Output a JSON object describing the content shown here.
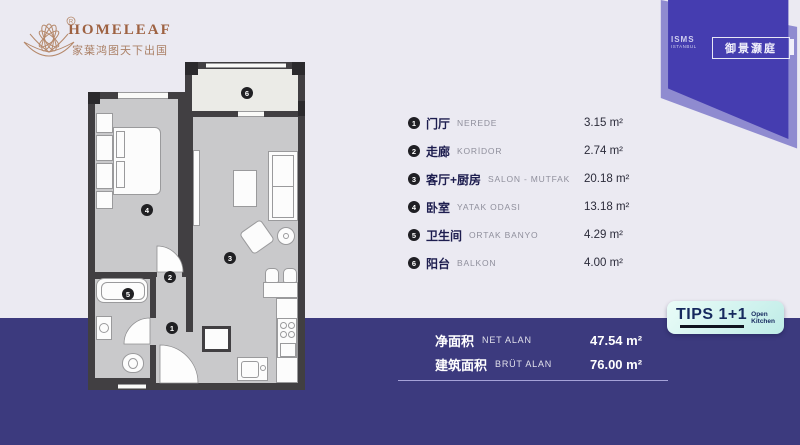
{
  "brand": {
    "name": "HOMELEAF",
    "tagline": "家葉鸿图天下出国",
    "registered_mark": "®"
  },
  "project_badge": {
    "name_line1": "ISMS",
    "name_line2": "ISTANBUL",
    "title_cn": "御景灏庭"
  },
  "tips_badge": {
    "title": "TIPS 1+1",
    "subtitle_line1": "Open",
    "subtitle_line2": "Kitchen"
  },
  "legend": {
    "rows": [
      {
        "num": "1",
        "cn": "门厅",
        "tr": "NEREDE",
        "area": "3.15 m²"
      },
      {
        "num": "2",
        "cn": "走廊",
        "tr": "KORİDOR",
        "area": "2.74 m²"
      },
      {
        "num": "3",
        "cn": "客厅+厨房",
        "tr": "SALON - MUTFAK",
        "area": "20.18 m²"
      },
      {
        "num": "4",
        "cn": "卧室",
        "tr": "YATAK ODASI",
        "area": "13.18 m²"
      },
      {
        "num": "5",
        "cn": "卫生间",
        "tr": "ORTAK BANYO",
        "area": "4.29 m²"
      },
      {
        "num": "6",
        "cn": "阳台",
        "tr": "BALKON",
        "area": "4.00 m²"
      }
    ]
  },
  "totals": {
    "rows": [
      {
        "cn": "净面积",
        "tr": "NET ALAN",
        "area": "47.54 m²"
      },
      {
        "cn": "建筑面积",
        "tr": "BRÜT ALAN",
        "area": "76.00 m²"
      }
    ]
  },
  "colors": {
    "background": "#ebeaf2",
    "band": "#3c3a7e",
    "flag": "#453db0",
    "flag_shadow": "#8f8bd0",
    "wall": "#413f42",
    "floor": "#c9c9cb",
    "balcony_floor": "#ebebe7",
    "brand_brown": "#9e6242",
    "tips_bg": "#cdeee9",
    "tips_text": "#16295e"
  }
}
